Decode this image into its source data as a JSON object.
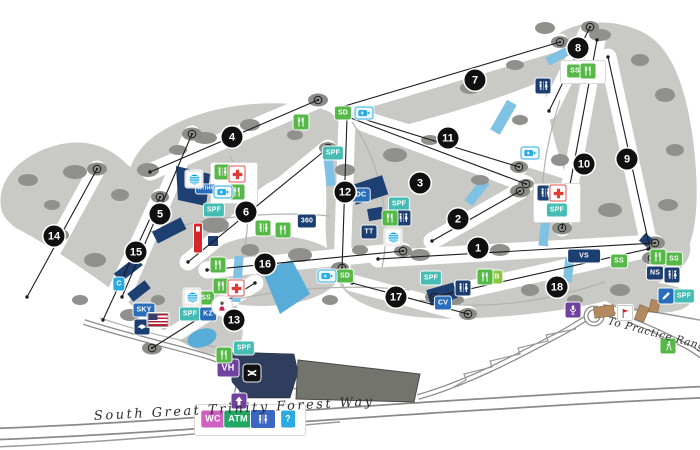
{
  "map": {
    "road_label": "South Great Trinity Forest Way",
    "practice_range_label": "To Practice Range"
  },
  "holes": [
    {
      "n": 1,
      "x": 478,
      "y": 248
    },
    {
      "n": 2,
      "x": 458,
      "y": 219
    },
    {
      "n": 3,
      "x": 420,
      "y": 183
    },
    {
      "n": 4,
      "x": 232,
      "y": 137
    },
    {
      "n": 5,
      "x": 160,
      "y": 214
    },
    {
      "n": 6,
      "x": 246,
      "y": 212
    },
    {
      "n": 7,
      "x": 475,
      "y": 80
    },
    {
      "n": 8,
      "x": 578,
      "y": 48
    },
    {
      "n": 9,
      "x": 627,
      "y": 159
    },
    {
      "n": 10,
      "x": 584,
      "y": 164
    },
    {
      "n": 11,
      "x": 448,
      "y": 138
    },
    {
      "n": 12,
      "x": 345,
      "y": 192
    },
    {
      "n": 13,
      "x": 234,
      "y": 320
    },
    {
      "n": 14,
      "x": 54,
      "y": 236
    },
    {
      "n": 15,
      "x": 136,
      "y": 252
    },
    {
      "n": 16,
      "x": 265,
      "y": 264
    },
    {
      "n": 17,
      "x": 396,
      "y": 297
    },
    {
      "n": 18,
      "x": 557,
      "y": 287
    }
  ],
  "icons": [
    {
      "name": "sd-station-1",
      "type": "label",
      "text": "SD",
      "color": "green",
      "x": 343,
      "y": 113
    },
    {
      "name": "sd-station-2",
      "type": "label",
      "text": "SD",
      "color": "green",
      "x": 345,
      "y": 276
    },
    {
      "name": "spf-station-1",
      "type": "label",
      "text": "SPF",
      "color": "teal",
      "x": 214,
      "y": 210
    },
    {
      "name": "spf-station-2",
      "type": "label",
      "text": "SPF",
      "color": "teal",
      "x": 333,
      "y": 153
    },
    {
      "name": "spf-station-3",
      "type": "label",
      "text": "SPF",
      "color": "teal",
      "x": 399,
      "y": 204
    },
    {
      "name": "spf-station-4",
      "type": "label",
      "text": "SPF",
      "color": "teal",
      "x": 557,
      "y": 210
    },
    {
      "name": "spf-station-5",
      "type": "label",
      "text": "SPF",
      "color": "teal",
      "x": 431,
      "y": 278
    },
    {
      "name": "spf-station-6",
      "type": "label",
      "text": "SPF",
      "color": "teal",
      "x": 190,
      "y": 314
    },
    {
      "name": "spf-station-7",
      "type": "label",
      "text": "SPF",
      "color": "teal",
      "x": 244,
      "y": 348
    },
    {
      "name": "spf-station-8",
      "type": "label",
      "text": "SPF",
      "color": "teal",
      "x": 684,
      "y": 296
    },
    {
      "name": "ss-station-1",
      "type": "label",
      "text": "SS",
      "color": "green",
      "x": 575,
      "y": 71
    },
    {
      "name": "ss-station-2",
      "type": "label",
      "text": "SS",
      "color": "green",
      "x": 206,
      "y": 298
    },
    {
      "name": "ss-station-3",
      "type": "label",
      "text": "SS",
      "color": "green",
      "x": 619,
      "y": 261
    },
    {
      "name": "ss-station-4",
      "type": "label",
      "text": "SS",
      "color": "green",
      "x": 674,
      "y": 259
    },
    {
      "name": "ns-station",
      "type": "label",
      "text": "NS",
      "color": "navy",
      "x": 655,
      "y": 273
    },
    {
      "name": "vs-station",
      "type": "label",
      "text": "VS",
      "color": "navy",
      "size": "wide",
      "x": 584,
      "y": 256
    },
    {
      "name": "mdc-station",
      "type": "label",
      "text": "MDC",
      "color": "blue",
      "x": 358,
      "y": 195
    },
    {
      "name": "tt-station",
      "type": "label",
      "text": "TT",
      "color": "navy",
      "x": 369,
      "y": 232
    },
    {
      "name": "club-360",
      "type": "label",
      "text": "360",
      "color": "navy",
      "x": 307,
      "y": 221
    },
    {
      "name": "cv-station",
      "type": "label",
      "text": "CV",
      "color": "blue",
      "x": 443,
      "y": 303
    },
    {
      "name": "kz-kids-zone",
      "type": "label",
      "text": "KZ",
      "color": "blue",
      "x": 208,
      "y": 314
    },
    {
      "name": "sky-suite",
      "type": "label",
      "text": "SKY",
      "color": "blue",
      "x": 144,
      "y": 310
    },
    {
      "name": "c-station",
      "type": "label",
      "text": "C",
      "color": "lightblue",
      "x": 119,
      "y": 284
    },
    {
      "name": "b-station",
      "type": "label",
      "text": "B",
      "color": "ltgreen",
      "x": 497,
      "y": 277
    },
    {
      "name": "volunteer-hq",
      "type": "label",
      "text": "VH",
      "color": "purple",
      "size": "big",
      "x": 228,
      "y": 368
    },
    {
      "name": "will-call",
      "type": "label",
      "text": "WC",
      "color": "pink",
      "size": "big",
      "x": 213,
      "y": 419
    },
    {
      "name": "atm",
      "type": "label",
      "text": "ATM",
      "color": "atmgreen",
      "size": "big",
      "x": 238,
      "y": 419
    },
    {
      "name": "info-question",
      "type": "label",
      "text": "?",
      "color": "lightblue",
      "size": "big",
      "x": 288,
      "y": 419
    },
    {
      "name": "ktihr-booth",
      "type": "label",
      "text": "KTIHR",
      "color": "blue",
      "size": "small",
      "x": 206,
      "y": 189
    },
    {
      "name": "restroom-1",
      "type": "restroom",
      "color": "green",
      "x": 222,
      "y": 172
    },
    {
      "name": "restroom-2",
      "type": "restroom",
      "color": "green",
      "x": 263,
      "y": 228
    },
    {
      "name": "restroom-3",
      "type": "restroom",
      "color": "navy",
      "x": 403,
      "y": 218
    },
    {
      "name": "restroom-4",
      "type": "restroom",
      "color": "navy",
      "x": 543,
      "y": 86
    },
    {
      "name": "restroom-5",
      "type": "restroom",
      "color": "navy",
      "x": 545,
      "y": 193
    },
    {
      "name": "restroom-6",
      "type": "restroom",
      "color": "navy",
      "x": 463,
      "y": 288
    },
    {
      "name": "restroom-7",
      "type": "restroom",
      "color": "navy",
      "x": 672,
      "y": 275
    },
    {
      "name": "restroom-8",
      "type": "restroom",
      "color": "royal",
      "size": "big",
      "x": 263,
      "y": 419
    },
    {
      "name": "concessions-1",
      "type": "food",
      "color": "green",
      "x": 237,
      "y": 192
    },
    {
      "name": "concessions-2",
      "type": "food",
      "color": "green",
      "x": 283,
      "y": 230
    },
    {
      "name": "concessions-3",
      "type": "food",
      "color": "green",
      "x": 301,
      "y": 122
    },
    {
      "name": "concessions-4",
      "type": "food",
      "color": "green",
      "x": 390,
      "y": 218
    },
    {
      "name": "concessions-5",
      "type": "food",
      "color": "green",
      "x": 588,
      "y": 71
    },
    {
      "name": "concessions-6",
      "type": "food",
      "color": "green",
      "x": 485,
      "y": 277
    },
    {
      "name": "concessions-7",
      "type": "food",
      "color": "green",
      "x": 658,
      "y": 257
    },
    {
      "name": "concessions-8",
      "type": "food",
      "color": "green",
      "x": 218,
      "y": 265
    },
    {
      "name": "concessions-9",
      "type": "food",
      "color": "green",
      "x": 221,
      "y": 286
    },
    {
      "name": "concessions-10",
      "type": "food",
      "color": "green",
      "x": 224,
      "y": 355
    },
    {
      "name": "first-aid-1",
      "type": "firstaid",
      "x": 237,
      "y": 174
    },
    {
      "name": "first-aid-2",
      "type": "firstaid",
      "x": 558,
      "y": 193
    },
    {
      "name": "first-aid-3",
      "type": "firstaid",
      "x": 236,
      "y": 288
    },
    {
      "name": "att-pavilion-1",
      "type": "att",
      "x": 194,
      "y": 179
    },
    {
      "name": "att-pavilion-2",
      "type": "att",
      "x": 192,
      "y": 297
    },
    {
      "name": "att-pavilion-3",
      "type": "att",
      "x": 393,
      "y": 237
    },
    {
      "name": "charging-station-1",
      "type": "battery",
      "x": 364,
      "y": 113
    },
    {
      "name": "charging-station-2",
      "type": "battery",
      "x": 327,
      "y": 276
    },
    {
      "name": "charging-station-3",
      "type": "battery",
      "x": 530,
      "y": 153
    },
    {
      "name": "charging-station-4",
      "type": "battery",
      "x": 223,
      "y": 192
    },
    {
      "name": "autograph-zone",
      "type": "pencil",
      "color": "blue",
      "x": 666,
      "y": 296
    },
    {
      "name": "broadcast-booth",
      "type": "mic",
      "color": "purple",
      "x": 573,
      "y": 310
    },
    {
      "name": "entrance-arrow",
      "type": "arrow",
      "color": "purple",
      "x": 239,
      "y": 401
    },
    {
      "name": "under-armour-shop",
      "type": "ua",
      "x": 252,
      "y": 373
    },
    {
      "name": "nursing-station",
      "type": "nursing",
      "x": 222,
      "y": 306
    },
    {
      "name": "eagle-club",
      "type": "eagle",
      "color": "navy",
      "x": 142,
      "y": 327
    },
    {
      "name": "us-flag",
      "type": "usflag",
      "x": 158,
      "y": 320
    },
    {
      "name": "practice-range-golfer",
      "type": "golfer",
      "color": "green",
      "x": 668,
      "y": 346
    },
    {
      "name": "red-banner",
      "type": "banner",
      "x": 198,
      "y": 238
    },
    {
      "name": "range-flag",
      "type": "flag",
      "x": 625,
      "y": 313
    }
  ]
}
